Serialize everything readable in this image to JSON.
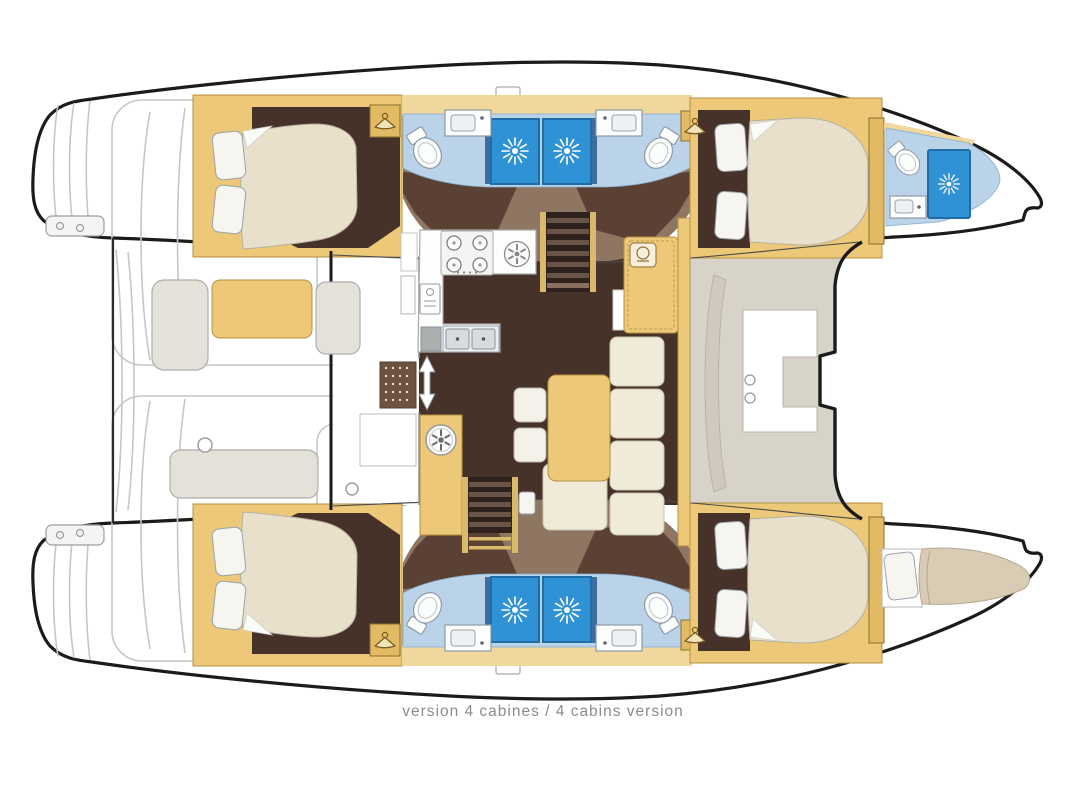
{
  "caption": {
    "text": "version 4 cabines / 4 cabins version"
  },
  "palette": {
    "outline": "#1b1b1b",
    "deck_gray": "#c6c6c6",
    "furniture_tan": "#ecc878",
    "furniture_tan_border": "#b5913f",
    "furniture_tan_light": "#f0d79c",
    "floor_dark": "#47322a",
    "floor_shadow": "#8e7663",
    "mattress_cream": "#e9e0cc",
    "mattress_border": "#b6b0a0",
    "bath_floor_blue": "#bad3e9",
    "shower_blue": "#2e92d5",
    "shower_border": "#1f6da6",
    "door_blue": "#3b6e9e",
    "seat_gray": "#e4e1d9",
    "fwd_cockpit_gray": "#d8d3c9",
    "cream_cushion": "#f0ead8",
    "caption_gray": "#8c8c8c"
  },
  "features": {
    "double_cabins": 4,
    "bathrooms": 5,
    "shower_sun_icons": 5,
    "hanger_wardrobes": 4,
    "bow_berth": 1,
    "galley_burners": 4,
    "galley_sink_basins": 2,
    "stairways": 2
  },
  "icons": {
    "shower-sun-icon": "white sunburst on blue shower tray",
    "hanger-icon": "clothes hanger in wardrobe locker",
    "stove-burners-icon": "four burner hob",
    "round-burner-icon": "large round burner",
    "oven-icon": "oven front",
    "vent-wheel-icon": "round wheel on galley cabinet",
    "door-arrow-icon": "double headed entry arrow",
    "toilet-icon": "toilet bowl",
    "sink-icon": "washbasin"
  }
}
